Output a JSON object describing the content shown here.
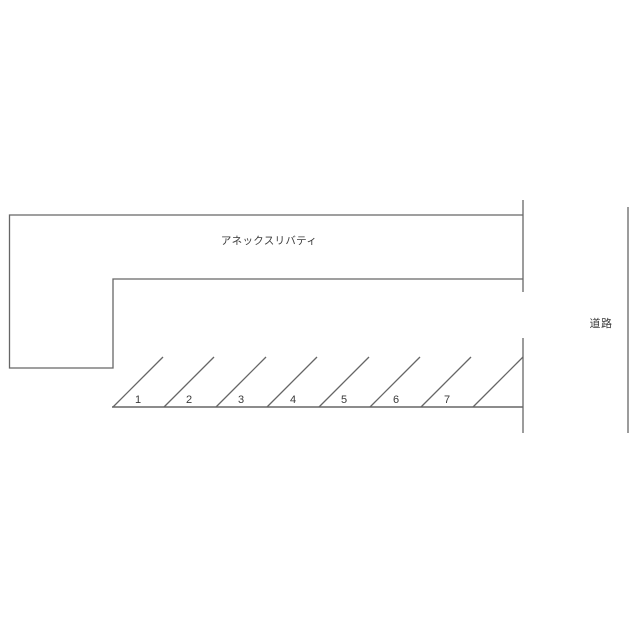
{
  "diagram": {
    "building_label": "アネックスリバティ",
    "road_label": "道路",
    "parking_spaces": [
      "1",
      "2",
      "3",
      "4",
      "5",
      "6",
      "7"
    ]
  },
  "colors": {
    "background": "#ffffff",
    "line": "#666666",
    "text": "#3a3a3a"
  }
}
